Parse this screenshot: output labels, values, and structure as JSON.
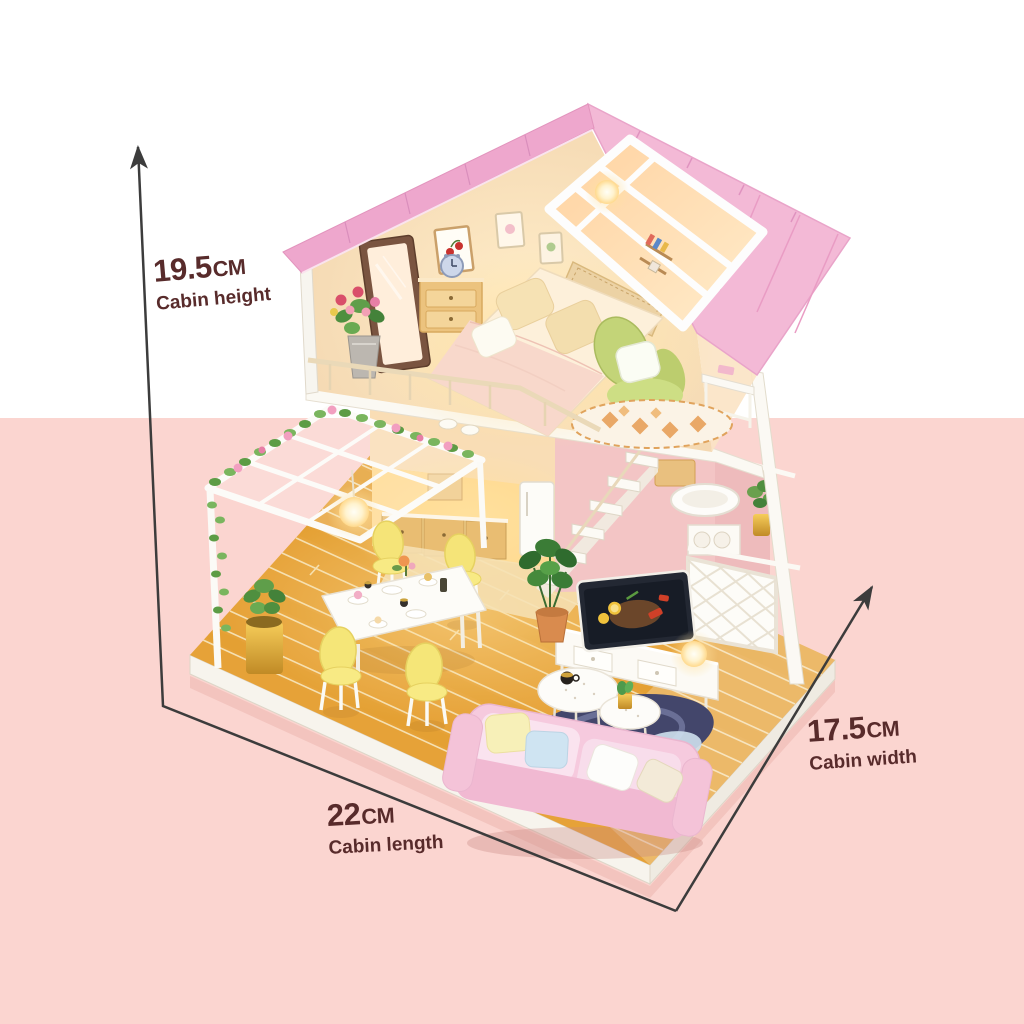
{
  "annotations": {
    "height": {
      "value": "19.5",
      "unit": "CM",
      "label": "Cabin height"
    },
    "length": {
      "value": "22",
      "unit": "CM",
      "label": "Cabin length"
    },
    "width": {
      "value": "17.5",
      "unit": "CM",
      "label": "Cabin width"
    }
  },
  "icons": {
    "height_arrow": "arrow-up-icon",
    "width_arrow": "arrow-up-right-icon"
  },
  "colors": {
    "background_top": "#ffffff",
    "background_bottom": "#fbd5d0",
    "label_text": "#582b2b",
    "dimension_line": "#3c3c3c",
    "roof_pink": "#f1aed0",
    "skylight_glow": "#ffd9a3",
    "deck_wood": "#e6a238",
    "sofa_pink": "#f6cade",
    "chair_yellow": "#f5e678",
    "armchair_green": "#c3d478"
  }
}
